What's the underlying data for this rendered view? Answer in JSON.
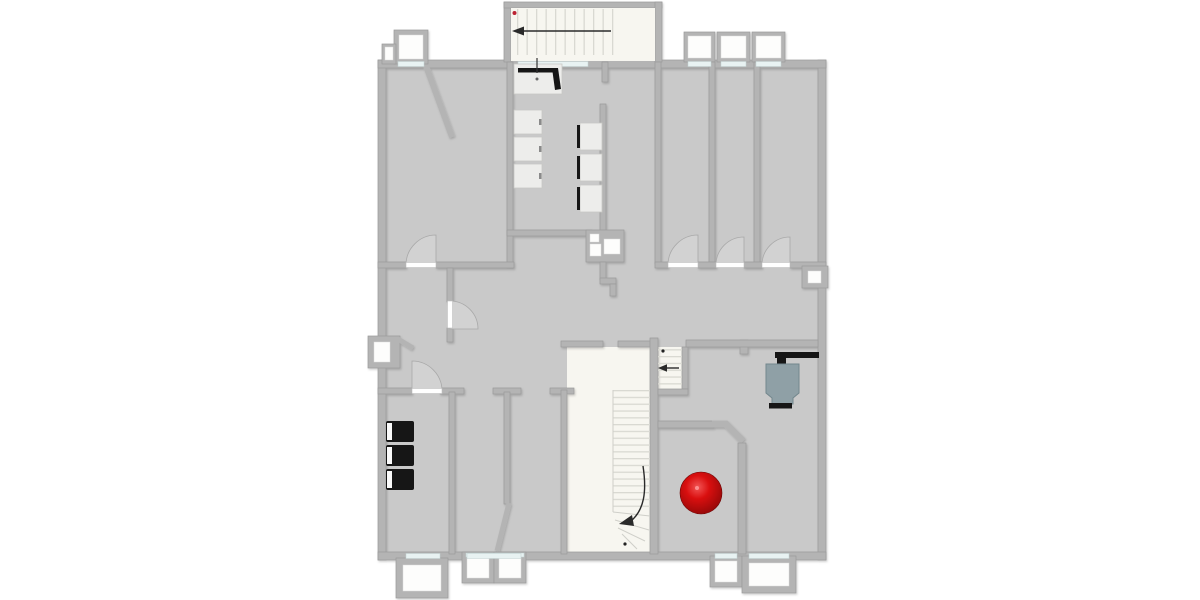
{
  "meta": {
    "title": "Building floor plan (top-down)",
    "canvas": {
      "width": 1200,
      "height": 600
    },
    "style": "architectural plan on white background, centered"
  },
  "colors": {
    "background": "#ffffff",
    "floor": "#c9c9c9",
    "wall": "#b4b4b4",
    "wall_edge": "#9a9a9a",
    "stairwell_floor": "#f7f6f0",
    "white_room": "#fdfdfc",
    "window_glass": "#e8f2f2",
    "door_swing": "#d2d2d2",
    "door_leaf": "#ffffff",
    "tread_line": "#d9d9d2",
    "furniture_white": "#ededeb",
    "furniture_black": "#161616",
    "object_teal": "#8fa0a6",
    "arrow": "#2a2a2a",
    "marker_red": "#bb2233",
    "sphere_highlight": "#f25555",
    "sphere_mid": "#d90f0f",
    "sphere_dark": "#7e0606"
  },
  "inventory": {
    "staircases": [
      {
        "name": "top-staircase",
        "arrow_direction": "left",
        "treads": 11,
        "marker": "red-dot"
      },
      {
        "name": "landing-staircase",
        "arrow_direction": "left",
        "treads": 6,
        "marker": "black-dot"
      },
      {
        "name": "main-staircase",
        "arrow_direction": "curved-down-left",
        "treads": 18,
        "marker": "black-dot"
      }
    ],
    "furniture": {
      "white_desks_left_column": 3,
      "white_desks_right_column_with_black_screens": 3,
      "black_cabinets": 3,
      "sink_piano_object_top": 1,
      "teal_object_right_room": 1,
      "red_sphere": 1,
      "duct_shaft_squares": 3
    },
    "openings": {
      "swing_doors": 6,
      "open_door_leaf_diagonal": 1,
      "wall_windows": 9,
      "bay_windows_top": 4,
      "porches_bottom": 4,
      "wall_mounted_box_right": 1
    }
  }
}
